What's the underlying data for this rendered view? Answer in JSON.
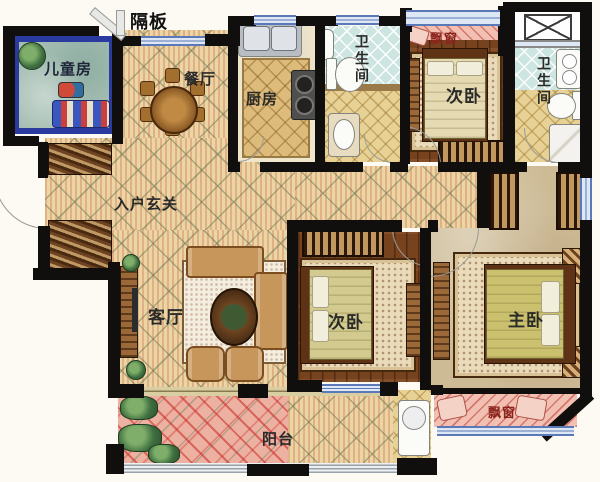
{
  "plan": {
    "partition_label": "隔板",
    "rooms": {
      "kids": "儿童房",
      "dining": "餐厅",
      "kitchen": "厨房",
      "bath1": "卫生间",
      "bath2": "卫生间",
      "bedroom_tr": "次卧",
      "bedroom_mid": "次卧",
      "master": "主卧",
      "foyer": "入户玄关",
      "living": "客厅",
      "balcony": "阳台",
      "bay_top": "飘窗",
      "bay_bottom": "飘窗"
    },
    "colors": {
      "wall": "#100f0d",
      "window_blue": "#5b79b8",
      "floor_cream": "#ecd5a5",
      "floor_wood": "#77431f",
      "floor_teal": "#a5beb2",
      "kids_room_border": "#2b3a9e",
      "balcony_pink": "#edb1a2",
      "bay_pink": "#f2c0b2",
      "tile_blue": "#cde5e1",
      "master_tan": "#cdbb96",
      "bay_label_red": "#8b241c"
    }
  }
}
